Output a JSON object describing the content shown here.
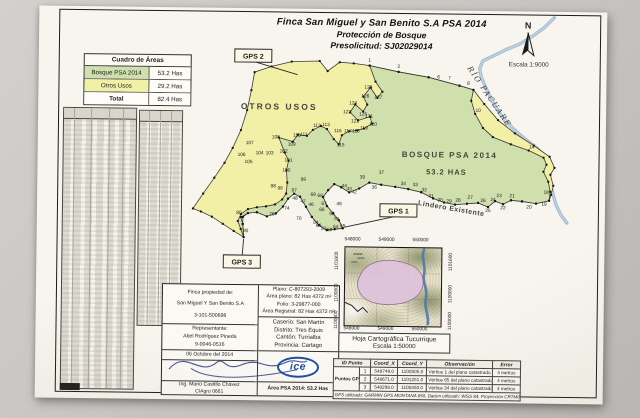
{
  "title": {
    "line1": "Finca San Miguel y San Benito S.A   PSA 2014",
    "line2": "Protección de Bosque",
    "line3": "Presolicitud: SJ02029014"
  },
  "area_table": {
    "title": "Cuadro de Áreas",
    "rows": [
      {
        "label": "Bosque PSA 2014",
        "value": "53.2 Has"
      },
      {
        "label": "Otros Usos",
        "value": "29.2 Has"
      },
      {
        "label": "Total",
        "value": "82.4 Has"
      }
    ]
  },
  "colors": {
    "bosque_green": "#cfe0ad",
    "otros_yellow": "#f2efa6",
    "river_blue": "#9db7cb",
    "inset_pink": "#dfc3dc",
    "ice_blue": "#1d4f9f"
  },
  "compass": {
    "north": "N",
    "scale": "Escala 1:9000"
  },
  "map": {
    "zones": [
      {
        "text": "OTROS USOS",
        "x": 241,
        "y": 101,
        "size": 8.5,
        "ls": 2,
        "rot": 0,
        "name": "zone-label-otros-usos"
      },
      {
        "text": "BOSQUE PSA 2014",
        "x": 412,
        "y": 147,
        "size": 8,
        "ls": 1.5,
        "rot": 0,
        "name": "zone-label-bosque"
      },
      {
        "text": "53.2 HAS",
        "x": 409,
        "y": 164,
        "size": 7.5,
        "ls": 1,
        "rot": 0,
        "name": "zone-label-bosque-area"
      },
      {
        "text": "Lindero Existente",
        "x": 414,
        "y": 200,
        "size": 7,
        "ls": 0.5,
        "rot": 9,
        "name": "boundary-label-lindero"
      },
      {
        "text": "RÍO PACUARE",
        "x": 449,
        "y": 87,
        "size": 7.5,
        "ls": 1.5,
        "rot": 55,
        "serif": true,
        "name": "river-label"
      }
    ],
    "gps_markers": [
      {
        "label": "GPS 2",
        "x": 196,
        "y": 41,
        "tx": 259,
        "ty": 66
      },
      {
        "label": "GPS 1",
        "x": 343,
        "y": 194,
        "tx": 307,
        "ty": 218
      },
      {
        "label": "GPS 3",
        "x": 187,
        "y": 247,
        "tx": 207,
        "ty": 231
      }
    ],
    "polygons": {
      "union_otros": [
        [
          216,
          64
        ],
        [
          233,
          58
        ],
        [
          253,
          53
        ],
        [
          281,
          52
        ],
        [
          289,
          62
        ],
        [
          301,
          53
        ],
        [
          315,
          54
        ],
        [
          331,
          56
        ],
        [
          360,
          62
        ],
        [
          390,
          67
        ],
        [
          421,
          75
        ],
        [
          435,
          79
        ],
        [
          446,
          93
        ],
        [
          460,
          109
        ],
        [
          477,
          122
        ],
        [
          496,
          134
        ],
        [
          512,
          145
        ],
        [
          517,
          156
        ],
        [
          513,
          163
        ],
        [
          516,
          174
        ],
        [
          514,
          183
        ],
        [
          512,
          189
        ],
        [
          499,
          192
        ],
        [
          485,
          190
        ],
        [
          474,
          189
        ],
        [
          466,
          193
        ],
        [
          458,
          190
        ],
        [
          451,
          196
        ],
        [
          441,
          192
        ],
        [
          430,
          193
        ],
        [
          418,
          194
        ],
        [
          407,
          192
        ],
        [
          396,
          188
        ],
        [
          384,
          182
        ],
        [
          371,
          179
        ],
        [
          358,
          177
        ],
        [
          344,
          175
        ],
        [
          332,
          173
        ],
        [
          322,
          179
        ],
        [
          312,
          183
        ],
        [
          304,
          178
        ],
        [
          297,
          175
        ],
        [
          291,
          181
        ],
        [
          286,
          188
        ],
        [
          290,
          197
        ],
        [
          296,
          204
        ],
        [
          302,
          211
        ],
        [
          306,
          219
        ],
        [
          298,
          220
        ],
        [
          290,
          221
        ],
        [
          282,
          216
        ],
        [
          275,
          208
        ],
        [
          269,
          198
        ],
        [
          263,
          188
        ],
        [
          257,
          185
        ],
        [
          251,
          190
        ],
        [
          246,
          198
        ],
        [
          239,
          205
        ],
        [
          230,
          208
        ],
        [
          220,
          204
        ],
        [
          211,
          205
        ],
        [
          206,
          209
        ],
        [
          206,
          216
        ],
        [
          207,
          229
        ],
        [
          197,
          223
        ],
        [
          186,
          216
        ],
        [
          175,
          209
        ],
        [
          164,
          204
        ],
        [
          156,
          201
        ],
        [
          166,
          186
        ],
        [
          177,
          170
        ],
        [
          187,
          155
        ],
        [
          195,
          140
        ],
        [
          203,
          122
        ],
        [
          209,
          102
        ],
        [
          213,
          82
        ]
      ],
      "bosque": [
        [
          331,
          56
        ],
        [
          360,
          62
        ],
        [
          390,
          67
        ],
        [
          421,
          75
        ],
        [
          435,
          79
        ],
        [
          433,
          90
        ],
        [
          437,
          103
        ],
        [
          445,
          117
        ],
        [
          455,
          126
        ],
        [
          473,
          133
        ],
        [
          491,
          139
        ],
        [
          506,
          146
        ],
        [
          509,
          153
        ],
        [
          506,
          160
        ],
        [
          511,
          170
        ],
        [
          513,
          180
        ],
        [
          512,
          189
        ],
        [
          499,
          192
        ],
        [
          485,
          190
        ],
        [
          474,
          189
        ],
        [
          466,
          193
        ],
        [
          458,
          190
        ],
        [
          451,
          196
        ],
        [
          441,
          192
        ],
        [
          430,
          193
        ],
        [
          418,
          194
        ],
        [
          407,
          192
        ],
        [
          396,
          188
        ],
        [
          384,
          182
        ],
        [
          371,
          179
        ],
        [
          358,
          177
        ],
        [
          344,
          175
        ],
        [
          332,
          173
        ],
        [
          322,
          179
        ],
        [
          312,
          183
        ],
        [
          304,
          178
        ],
        [
          297,
          175
        ],
        [
          291,
          181
        ],
        [
          286,
          188
        ],
        [
          290,
          197
        ],
        [
          296,
          204
        ],
        [
          302,
          211
        ],
        [
          306,
          219
        ],
        [
          298,
          220
        ],
        [
          290,
          221
        ],
        [
          282,
          216
        ],
        [
          275,
          208
        ],
        [
          269,
          198
        ],
        [
          263,
          188
        ],
        [
          257,
          185
        ],
        [
          251,
          190
        ],
        [
          246,
          198
        ],
        [
          239,
          205
        ],
        [
          230,
          208
        ],
        [
          220,
          204
        ],
        [
          211,
          205
        ],
        [
          204,
          209
        ],
        [
          206,
          216
        ],
        [
          207,
          229
        ],
        [
          204,
          221
        ],
        [
          201,
          213
        ],
        [
          204,
          206
        ],
        [
          211,
          201
        ],
        [
          220,
          199
        ],
        [
          229,
          198
        ],
        [
          238,
          196
        ],
        [
          245,
          191
        ],
        [
          249,
          185
        ],
        [
          250,
          174
        ],
        [
          249,
          162
        ],
        [
          251,
          152
        ],
        [
          247,
          144
        ],
        [
          241,
          129
        ],
        [
          255,
          133
        ],
        [
          260,
          126
        ],
        [
          269,
          127
        ],
        [
          275,
          121
        ],
        [
          283,
          117
        ],
        [
          289,
          120
        ],
        [
          296,
          130
        ],
        [
          301,
          135
        ],
        [
          304,
          126
        ],
        [
          311,
          122
        ],
        [
          319,
          121
        ],
        [
          326,
          119
        ],
        [
          334,
          114
        ],
        [
          332,
          107
        ],
        [
          320,
          111
        ],
        [
          312,
          103
        ],
        [
          317,
          95
        ],
        [
          325,
          102
        ],
        [
          329,
          95
        ],
        [
          325,
          87
        ],
        [
          332,
          78
        ],
        [
          339,
          88
        ],
        [
          344,
          82
        ],
        [
          337,
          72
        ]
      ]
    },
    "river_path": [
      [
        515,
        6
      ],
      [
        505,
        16
      ],
      [
        493,
        25
      ],
      [
        480,
        33
      ],
      [
        468,
        38
      ],
      [
        456,
        44
      ],
      [
        444,
        50
      ],
      [
        441,
        58
      ],
      [
        443,
        67
      ],
      [
        448,
        78
      ],
      [
        454,
        90
      ],
      [
        460,
        100
      ],
      [
        466,
        108
      ],
      [
        474,
        116
      ],
      [
        483,
        124
      ],
      [
        492,
        131
      ],
      [
        500,
        137
      ],
      [
        506,
        144
      ],
      [
        509,
        152
      ],
      [
        511,
        162
      ],
      [
        513,
        172
      ],
      [
        516,
        183
      ],
      [
        519,
        193
      ],
      [
        524,
        203
      ],
      [
        530,
        211
      ]
    ],
    "vertex_labels": [
      [
        1,
        331,
        52
      ],
      [
        2,
        360,
        58
      ],
      [
        6,
        400,
        68
      ],
      [
        7,
        411,
        69
      ],
      [
        8,
        430,
        74
      ],
      [
        10,
        440,
        101
      ],
      [
        14,
        494,
        137
      ],
      [
        18,
        509,
        182
      ],
      [
        19,
        507,
        194
      ],
      [
        20,
        492,
        197
      ],
      [
        21,
        475,
        186
      ],
      [
        22,
        466,
        198
      ],
      [
        23,
        462,
        186
      ],
      [
        24,
        456,
        190
      ],
      [
        25,
        451,
        201
      ],
      [
        26,
        446,
        191
      ],
      [
        27,
        433,
        188
      ],
      [
        28,
        421,
        191
      ],
      [
        29,
        412,
        192
      ],
      [
        30,
        403,
        191
      ],
      [
        31,
        394,
        187
      ],
      [
        32,
        387,
        181
      ],
      [
        33,
        378,
        176
      ],
      [
        34,
        366,
        175
      ],
      [
        36,
        337,
        179
      ],
      [
        37,
        344,
        164
      ],
      [
        39,
        325,
        169
      ],
      [
        42,
        317,
        184
      ],
      [
        43,
        312,
        181
      ],
      [
        44,
        307,
        178
      ],
      [
        46,
        274,
        197
      ],
      [
        47,
        266,
        194
      ],
      [
        48,
        258,
        191
      ],
      [
        49,
        302,
        196
      ],
      [
        50,
        295,
        206
      ],
      [
        51,
        300,
        211
      ],
      [
        54,
        279,
        215
      ],
      [
        57,
        287,
        221
      ],
      [
        58,
        293,
        222
      ],
      [
        63,
        282,
        218
      ],
      [
        64,
        299,
        219
      ],
      [
        65,
        306,
        218
      ],
      [
        66,
        285,
        202
      ],
      [
        67,
        287,
        196
      ],
      [
        68,
        283,
        188
      ],
      [
        69,
        276,
        187
      ],
      [
        70,
        262,
        211
      ],
      [
        74,
        250,
        201
      ],
      [
        76,
        235,
        207
      ],
      [
        80,
        202,
        206
      ],
      [
        90,
        209,
        224
      ],
      [
        96,
        243,
        181
      ],
      [
        97,
        257,
        183
      ],
      [
        98,
        236,
        179
      ],
      [
        99,
        266,
        172
      ],
      [
        100,
        249,
        163
      ],
      [
        101,
        251,
        153
      ],
      [
        102,
        246,
        144
      ],
      [
        103,
        232,
        146
      ],
      [
        104,
        222,
        146
      ],
      [
        105,
        211,
        155
      ],
      [
        106,
        204,
        148
      ],
      [
        107,
        212,
        136
      ],
      [
        108,
        238,
        130
      ],
      [
        109,
        254,
        137
      ],
      [
        110,
        259,
        128
      ],
      [
        111,
        266,
        127
      ],
      [
        112,
        279,
        118
      ],
      [
        113,
        288,
        117
      ],
      [
        115,
        303,
        137
      ],
      [
        116,
        300,
        123
      ],
      [
        117,
        310,
        123
      ],
      [
        118,
        318,
        123
      ],
      [
        119,
        326,
        120
      ],
      [
        120,
        335,
        116
      ],
      [
        121,
        331,
        108
      ],
      [
        122,
        317,
        113
      ],
      [
        123,
        309,
        104
      ],
      [
        124,
        315,
        95
      ],
      [
        125,
        325,
        106
      ],
      [
        126,
        327,
        88
      ],
      [
        127,
        340,
        89
      ],
      [
        128,
        330,
        79
      ]
    ]
  },
  "info_block": {
    "owner_heading": "Finca propiedad de:",
    "owner_name": "San Miguel Y San Benito S.A",
    "owner_id": "3-101-500698",
    "rep_heading": "Representante:",
    "rep_name": "Abel Rodríguez Pineda",
    "rep_id": "9-0046-0516",
    "date": "06 Octubre del 2014",
    "engineer": "Ing. Mario Castillo Chávez",
    "engineer_reg": "CIAgro 0661",
    "plano": "Plano: C-807293-2009",
    "area_plano": "Área plano: 82 Has 4372 m²",
    "folio": "Folio: 3-29877-000",
    "area_registral": "Área Registral: 82 Has 4372 m²",
    "caserio": "Caserío: San Martín",
    "distrito": "Distrito: Tres Equis",
    "canton": "Cantón: Turrialba",
    "provincia": "Provincia: Cartago",
    "ice_logo": "ice",
    "area_psa": "Área PSA 2014: 53.2 Has"
  },
  "inset": {
    "x_ticks": [
      "548000",
      "549000",
      "550000"
    ],
    "y_ticks": [
      "1101600",
      "1100800",
      "1100000"
    ],
    "caption_line1": "Hoja Cartográfica Tucurrique",
    "caption_line2": "Escala 1:50000"
  },
  "gps_table": {
    "headers": [
      "ID Punto",
      "Coord_X",
      "Coord_Y",
      "Observación",
      "Error"
    ],
    "group_label": "Puntos GPS",
    "rows": [
      [
        "1",
        "548749.0",
        "1100505.0",
        "Vértice 1 del plano catastrado",
        "4 metros"
      ],
      [
        "2",
        "548671.0",
        "1101251.0",
        "Vértice 65 del plano catastrado",
        "4 metros"
      ],
      [
        "3",
        "548298.0",
        "1100450.0",
        "Vértice 34 del plano catastrado",
        "4 metros"
      ]
    ],
    "footer": "GPS utilizado: GARMIN GPS MONTANA 650, Datum utilizado: WGS 84, Proyección CRTM05"
  }
}
